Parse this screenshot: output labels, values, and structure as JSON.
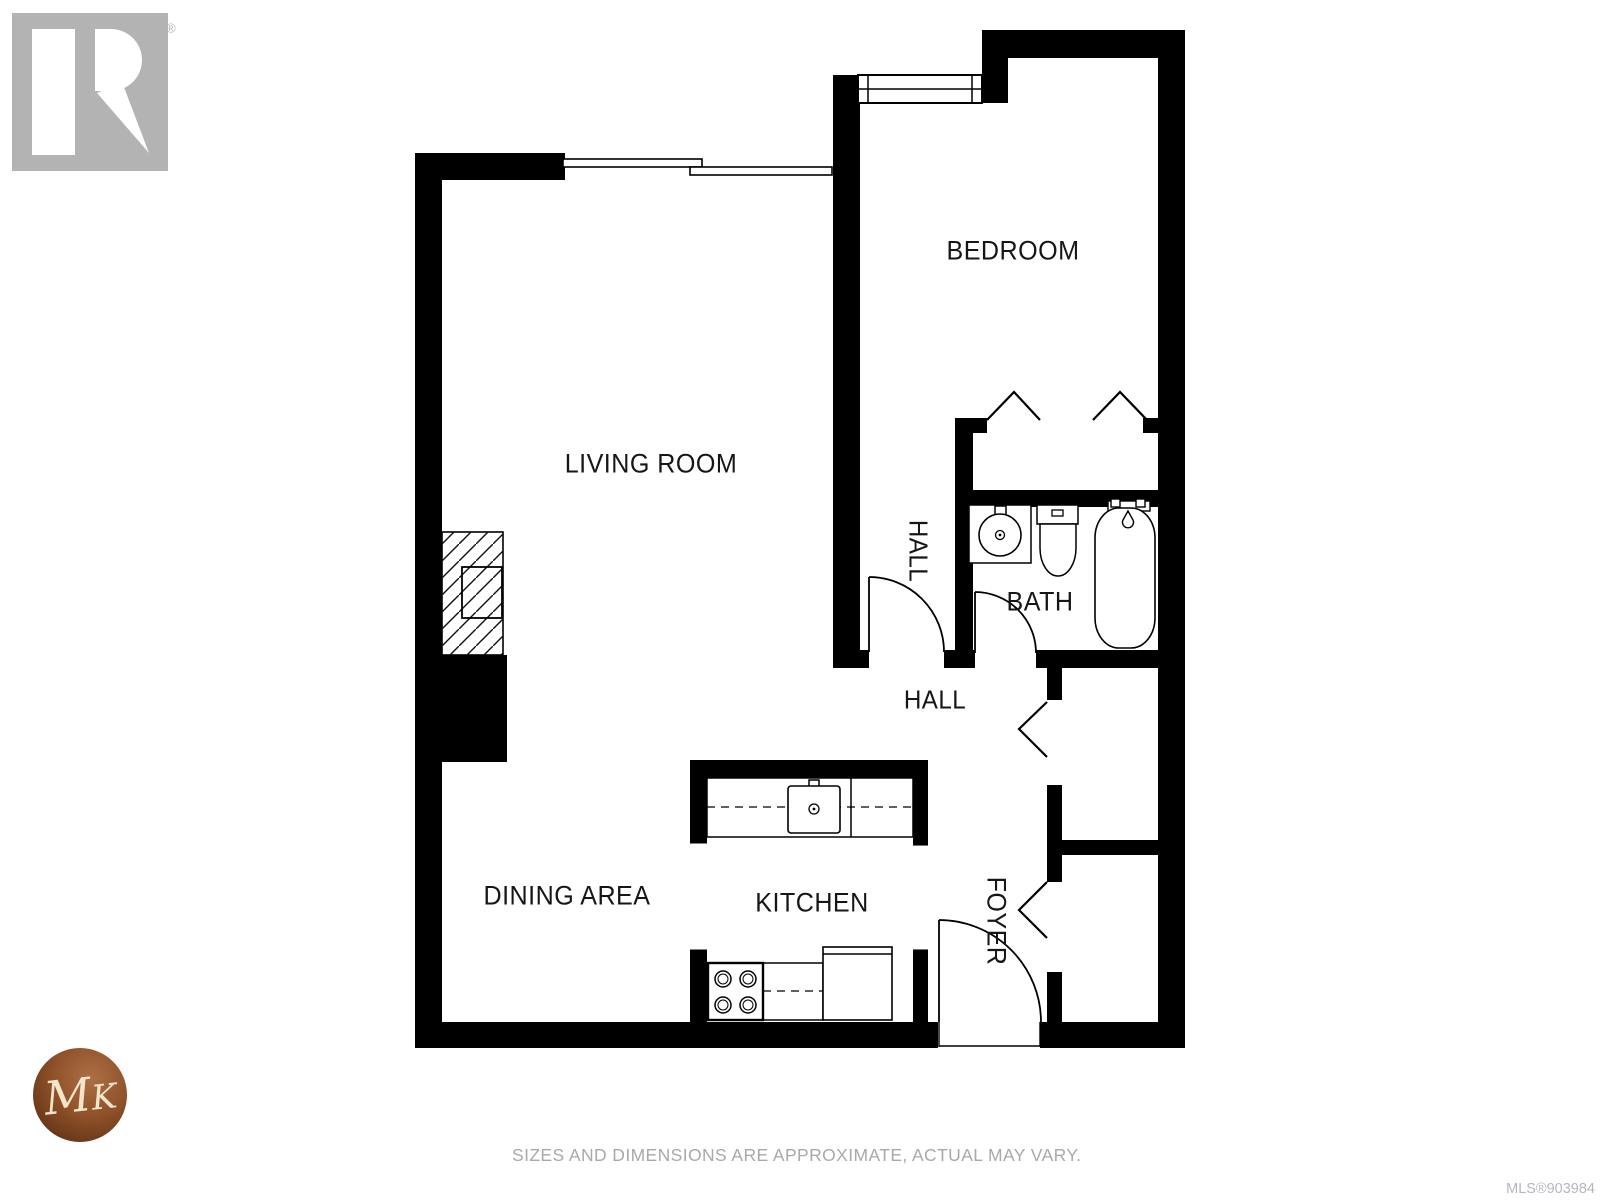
{
  "watermark": {
    "realtor_wordmark": "REALTOR",
    "registered_mark": "®",
    "monogram_m": "M",
    "monogram_k": "K"
  },
  "rooms": {
    "bedroom": "BEDROOM",
    "living_room": "LIVING ROOM",
    "hall_upper": "HALL",
    "bath": "BATH",
    "hall_lower": "HALL",
    "dining_area": "DINING AREA",
    "kitchen": "KITCHEN",
    "foyer": "FOYER"
  },
  "footer": {
    "disclaimer": "SIZES AND DIMENSIONS ARE APPROXIMATE, ACTUAL MAY VARY.",
    "mls_number": "MLS®903984"
  },
  "colors": {
    "wall": "#000000",
    "room_label": "#161616",
    "watermark_gray": "#b3b3b3",
    "disclaimer_gray": "#a9a9a9",
    "mls_gray": "#b5b7bf",
    "mk_copper_light": "#ad6f45",
    "mk_copper": "#8f5129",
    "mk_copper_dark": "#542a11",
    "mk_cream": "#f2e5c9"
  }
}
